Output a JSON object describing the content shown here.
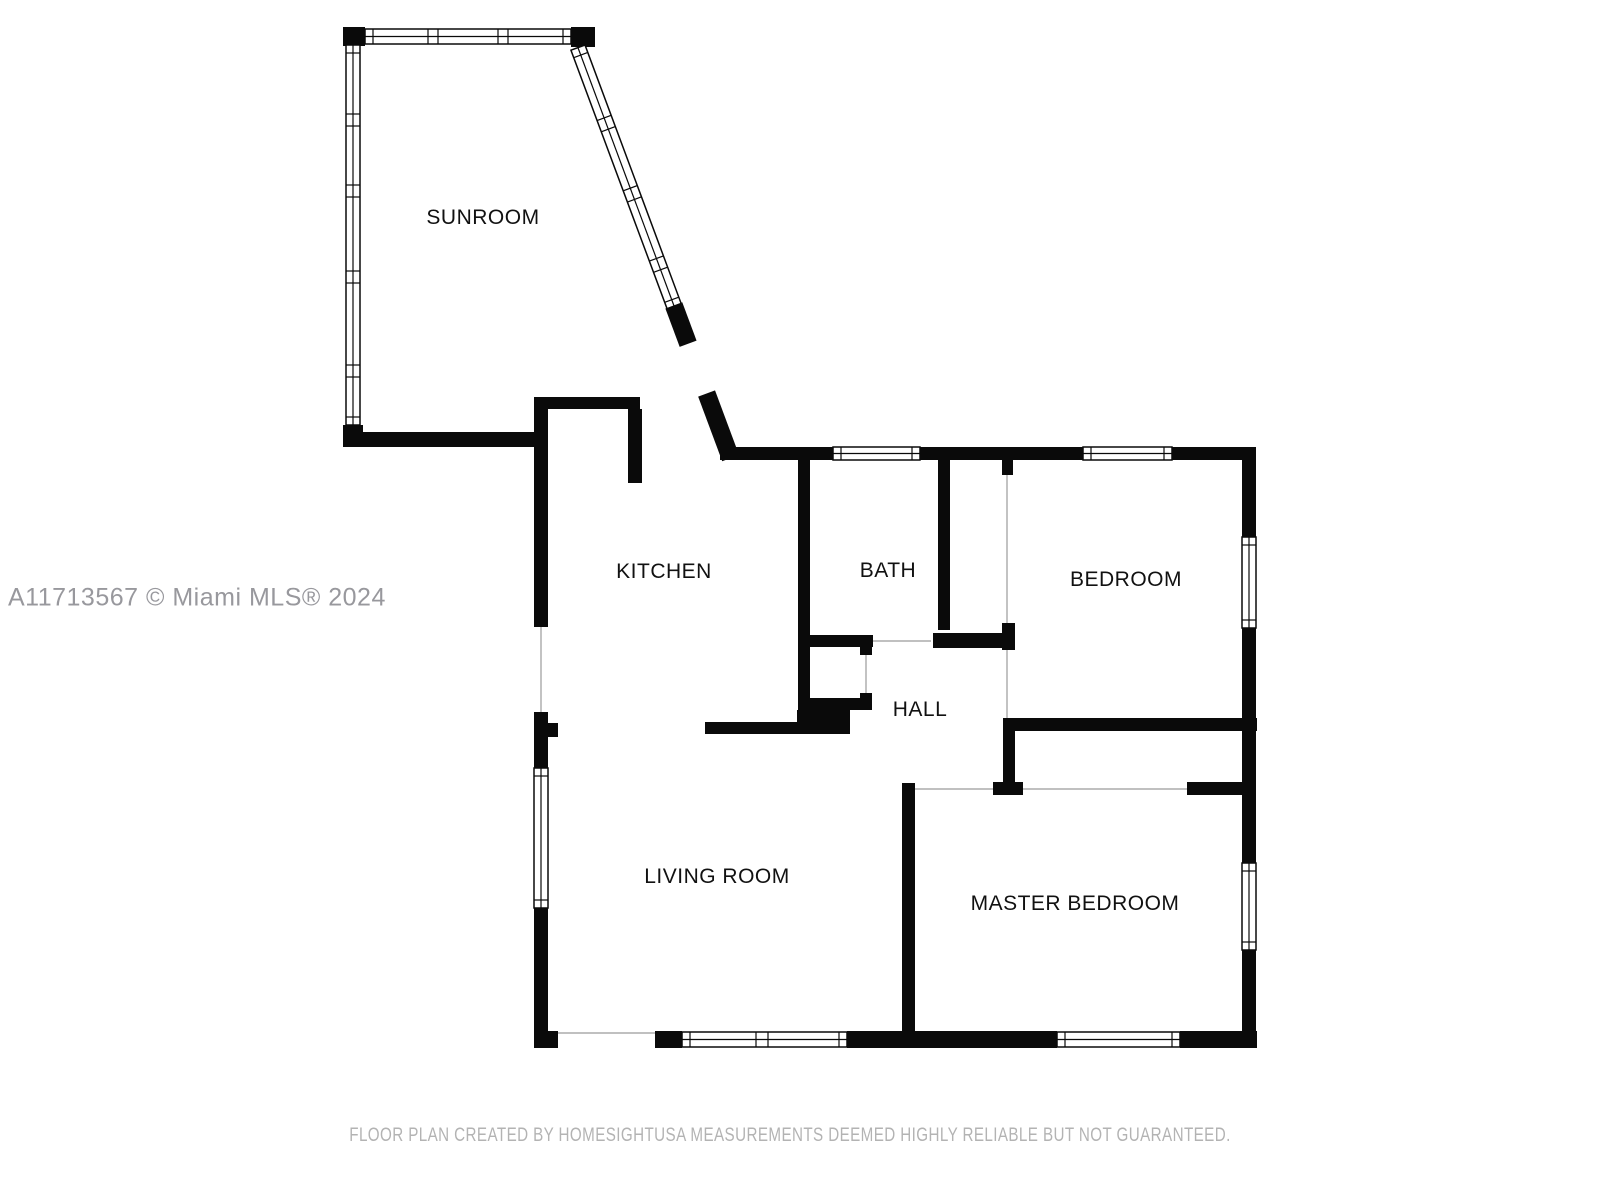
{
  "plan": {
    "type": "floor-plan",
    "watermark": "A11713567 © Miami MLS® 2024",
    "footer": "FLOOR PLAN CREATED BY HOMESIGHTUSA MEASUREMENTS DEEMED HIGHLY RELIABLE BUT NOT GUARANTEED.",
    "rooms": [
      {
        "name": "SUNROOM"
      },
      {
        "name": "KITCHEN"
      },
      {
        "name": "BATH"
      },
      {
        "name": "BEDROOM"
      },
      {
        "name": "HALL"
      },
      {
        "name": "LIVING ROOM"
      },
      {
        "name": "MASTER BEDROOM"
      }
    ],
    "colors": {
      "wall": "#0a0a0a",
      "room_label": "#111111",
      "watermark": "#98989d",
      "footer": "#b3b3b3",
      "background": "#ffffff"
    }
  }
}
